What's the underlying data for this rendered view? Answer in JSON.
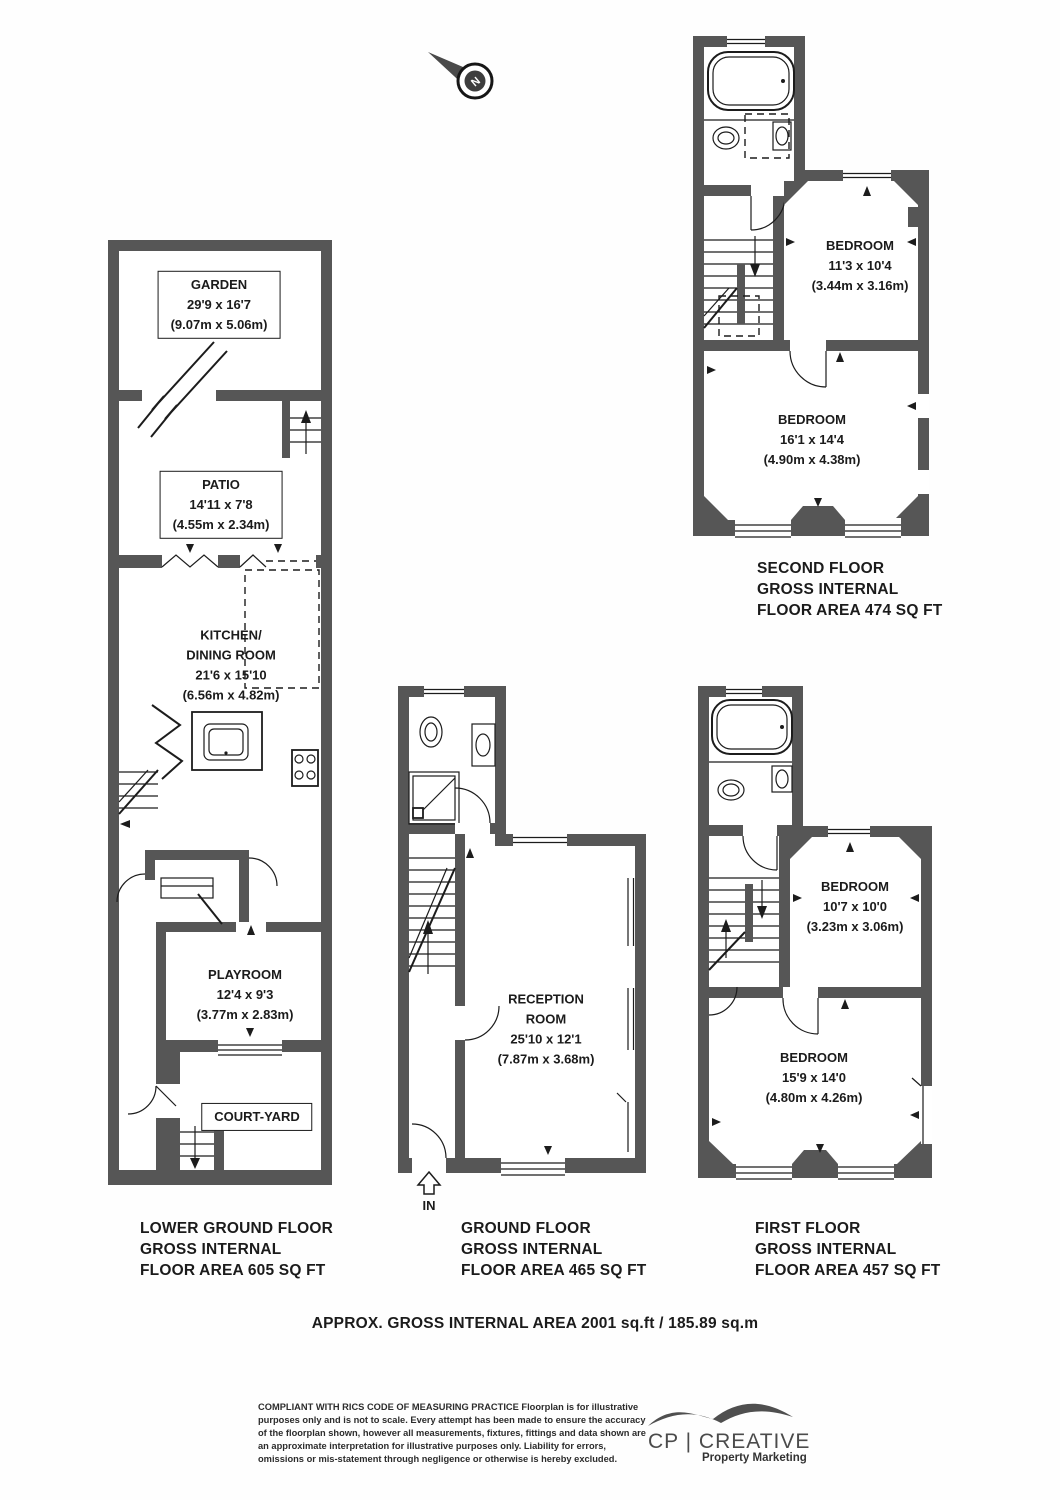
{
  "compass": {
    "letter": "N"
  },
  "plans": {
    "lower_ground": {
      "caption_lines": [
        "LOWER GROUND FLOOR",
        "GROSS INTERNAL",
        "FLOOR AREA 605 SQ FT"
      ],
      "garden": {
        "title": "GARDEN",
        "imperial": "29'9 x 16'7",
        "metric": "(9.07m x 5.06m)"
      },
      "patio": {
        "title": "PATIO",
        "imperial": "14'11 x 7'8",
        "metric": "(4.55m x 2.34m)"
      },
      "kitchen": {
        "title_line1": "KITCHEN/",
        "title_line2": "DINING ROOM",
        "imperial": "21'6 x 15'10",
        "metric": "(6.56m x 4.82m)"
      },
      "playroom": {
        "title": "PLAYROOM",
        "imperial": "12'4 x 9'3",
        "metric": "(3.77m x 2.83m)"
      },
      "courtyard": {
        "title": "COURT-YARD"
      }
    },
    "ground": {
      "caption_lines": [
        "GROUND FLOOR",
        "GROSS INTERNAL",
        "FLOOR AREA 465 SQ FT"
      ],
      "reception": {
        "title_line1": "RECEPTION",
        "title_line2": "ROOM",
        "imperial": "25'10 x 12'1",
        "metric": "(7.87m x 3.68m)"
      },
      "entrance_label": "IN"
    },
    "first": {
      "caption_lines": [
        "FIRST FLOOR",
        "GROSS INTERNAL",
        "FLOOR AREA 457 SQ FT"
      ],
      "bedroom_small": {
        "title": "BEDROOM",
        "imperial": "10'7 x 10'0",
        "metric": "(3.23m x 3.06m)"
      },
      "bedroom_large": {
        "title": "BEDROOM",
        "imperial": "15'9 x 14'0",
        "metric": "(4.80m x 4.26m)"
      }
    },
    "second": {
      "caption_lines": [
        "SECOND FLOOR",
        "GROSS INTERNAL",
        "FLOOR AREA 474 SQ FT"
      ],
      "bedroom_small": {
        "title": "BEDROOM",
        "imperial": "11'3 x 10'4",
        "metric": "(3.44m x 3.16m)"
      },
      "bedroom_large": {
        "title": "BEDROOM",
        "imperial": "16'1 x 14'4",
        "metric": "(4.90m x 4.38m)"
      }
    }
  },
  "summary": "APPROX. GROSS INTERNAL AREA 2001 sq.ft / 185.89 sq.m",
  "disclaimer": {
    "lead": "COMPLIANT WITH RICS CODE OF MEASURING PRACTICE",
    "body": "  Floorplan is for illustrative purposes only and is not to scale. Every attempt has been made to ensure the accuracy of the floorplan shown, however all measurements, fixtures, fittings and data shown are an approximate interpretation for illustrative purposes only. Liability for errors, omissions or mis-statement through negligence or otherwise is hereby excluded."
  },
  "logo": {
    "brand": "CP | CREATIVE",
    "tagline": "Property Marketing"
  },
  "colors": {
    "wall": "#565656",
    "line": "#1c1c1c"
  }
}
